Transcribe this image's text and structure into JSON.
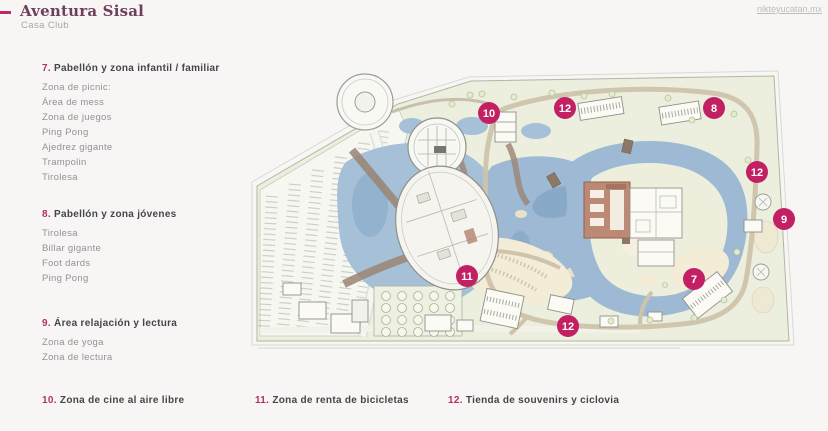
{
  "header": {
    "title": "Aventura Sisal",
    "subtitle": "Casa Club",
    "website": "nikteyucatan.mx"
  },
  "legend_sections": [
    {
      "number": "7.",
      "title": "Pabellón y zona infantil / familiar",
      "items": [
        "Zona de picnic:",
        "Área de mess",
        "Zona de juegos",
        "Ping Pong",
        "Ajedrez gigante",
        "Trampolin",
        "Tirolesa"
      ]
    },
    {
      "number": "8.",
      "title": "Pabellón y zona jóvenes",
      "items": [
        "Tirolesa",
        "Billar gigante",
        "Foot dards",
        "Ping Pong"
      ]
    },
    {
      "number": "9.",
      "title": "Área relajación y lectura",
      "items": [
        "Zona de yoga",
        "Zona de lectura"
      ]
    }
  ],
  "bottom_legend": [
    {
      "number": "10.",
      "title": "Zona de cine al aire libre"
    },
    {
      "number": "11.",
      "title": "Zona de renta de bicicletas"
    },
    {
      "number": "12.",
      "title": "Tienda de souvenirs y ciclovia"
    }
  ],
  "map": {
    "badges": [
      {
        "label": "10"
      },
      {
        "label": "12"
      },
      {
        "label": "8"
      },
      {
        "label": "12"
      },
      {
        "label": "9"
      },
      {
        "label": "7"
      },
      {
        "label": "11"
      },
      {
        "label": "12"
      }
    ],
    "colors": {
      "badge": "#c32064",
      "water": "#9db9d3",
      "land": "#ecefdd",
      "road": "#cfc3aa",
      "building_accent": "#bc8a74"
    }
  },
  "brand_colors": {
    "accent": "#c2276d",
    "title": "#6e3f5d"
  }
}
